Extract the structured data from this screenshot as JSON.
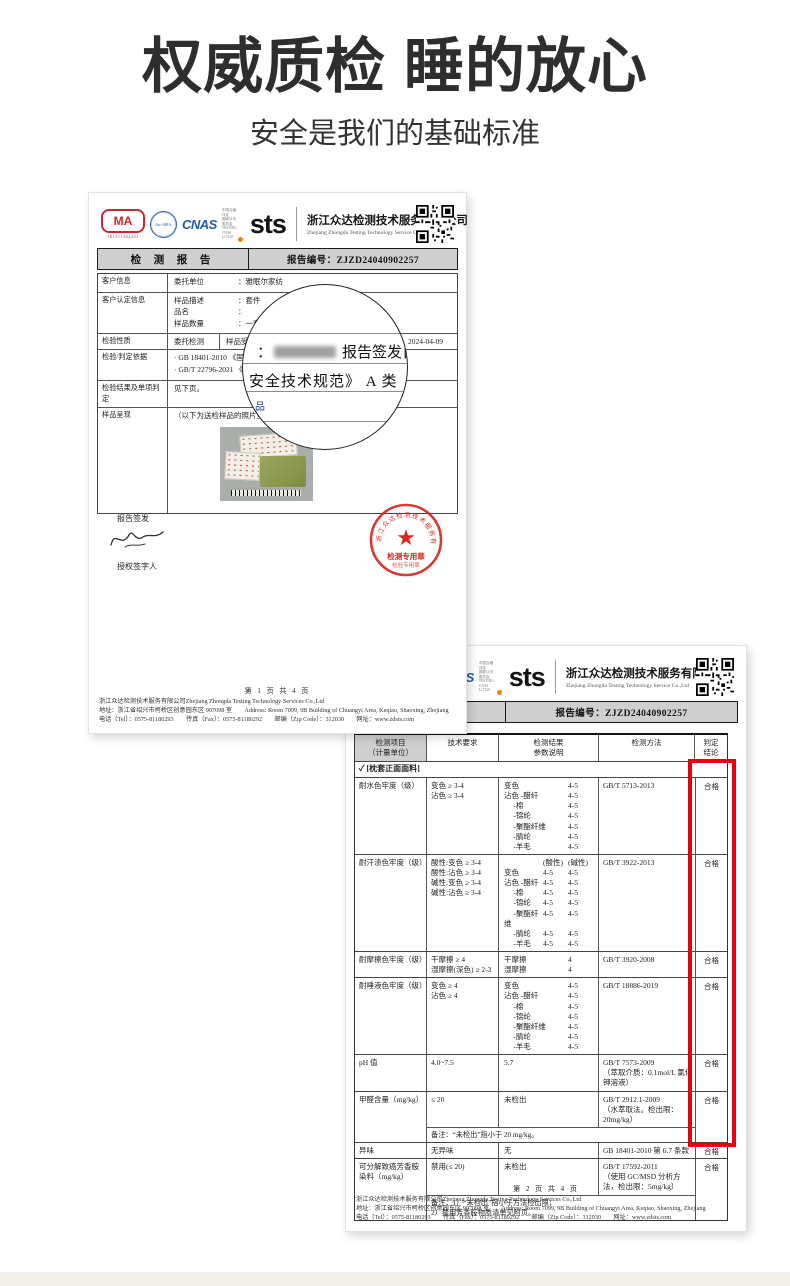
{
  "page": {
    "title": "权威质检 睡的放心",
    "subtitle": "安全是我们的基础标准"
  },
  "colors": {
    "accent_red": "#e60012",
    "stamp_red": "#d5281e",
    "logo_blue": "#1f5caa",
    "logo_orange": "#f08300",
    "bar_gray": "#cfcfcf"
  },
  "company": {
    "name_cn": "浙江众达检测技术服务有限公司",
    "name_en": "Zhejiang Zhongda Testing Technology Service Co.,Ltd",
    "logos": {
      "cma": "MA",
      "cma_number": "181511262431",
      "ilac": "ilac-MRA",
      "cnas": "CNAS",
      "cnas_side": [
        "中国合格评定",
        "国家认可",
        "委员会",
        "TESTING",
        "CNAS L17128"
      ],
      "sts": "sts",
      "qr": "qr-code-icon"
    }
  },
  "report": {
    "title_bar": "检 测 报 告",
    "report_no": "报告编号：ZJZD24040902257"
  },
  "doc1": {
    "info_rows": [
      {
        "label": "客户信息",
        "pairs": [
          [
            "委托单位",
            "：雅眠尔家纺"
          ]
        ]
      },
      {
        "label": "客户认定信息",
        "pairs": [
          [
            "样品描述",
            "：套件"
          ],
          [
            "品名",
            "："
          ],
          [
            "样品数量",
            "：一套"
          ]
        ]
      },
      {
        "label": "检验性质",
        "mid": "委托检测",
        "right_label": "样品受理日期：",
        "right_value": "2024-04-09"
      },
      {
        "label": "检验/判定依据",
        "lines": [
          "· GB 18401-2010 《国家",
          "· GB/T 22796-2021 《床"
        ]
      },
      {
        "label": "检验结果及单项判定",
        "lines": [
          "见下页。"
        ]
      },
      {
        "label": "样品呈现",
        "lines": [
          "（以下为送检样品的照片呈现）"
        ],
        "photo": true
      }
    ],
    "magnifier": {
      "line1_prefix": "：",
      "line1_suffix": "报告签发日",
      "line2": "安全技术规范》 A 类",
      "small": "品"
    },
    "sign": {
      "issue_label": "报告签发",
      "authorized_label": "授权签字人"
    },
    "stamp": {
      "ring_text": "浙江众达检测技术服务有限公司",
      "label": "检测专用章",
      "label2": "检验专用章"
    },
    "footer_page": "第 1 页 共 4 页"
  },
  "doc2": {
    "table": {
      "headers": [
        [
          "检测项目",
          "（计量单位）"
        ],
        [
          "技术要求",
          ""
        ],
        [
          "检测结果",
          "参数说明"
        ],
        [
          "检测方法",
          ""
        ],
        [
          "判定",
          "结论"
        ]
      ],
      "section": "✓ [枕套正面面料]",
      "rows": [
        {
          "item": "耐水色牢度（级）",
          "req": [
            "变色 ≥ 3-4",
            "沾色 ≥ 3-4"
          ],
          "result": [
            [
              "变色",
              "4-5"
            ],
            [
              "沾色 -醋纤",
              "4-5"
            ],
            [
              "　 -棉",
              "4-5"
            ],
            [
              "　 -锦纶",
              "4-5"
            ],
            [
              "　 -聚酯纤维",
              "4-5"
            ],
            [
              "　 -腈纶",
              "4-5"
            ],
            [
              "　 -羊毛",
              "4-5"
            ]
          ],
          "method": [
            "GB/T 5713-2013"
          ],
          "verdict": "合格"
        },
        {
          "item": "耐汗渍色牢度（级）",
          "req": [
            "酸性:变色 ≥ 3-4",
            "酸性:沾色 ≥ 3-4",
            "碱性:变色 ≥ 3-4",
            "碱性:沾色 ≥ 3-4"
          ],
          "result": [
            [
              "",
              "(酸性)",
              "(碱性)"
            ],
            [
              "变色",
              "4-5",
              "4-5"
            ],
            [
              "沾色 -醋纤",
              "4-5",
              "4-5"
            ],
            [
              "　 -棉",
              "4-5",
              "4-5"
            ],
            [
              "　 -锦纶",
              "4-5",
              "4-5"
            ],
            [
              "　 -聚酯纤维",
              "4-5",
              "4-5"
            ],
            [
              "　 -腈纶",
              "4-5",
              "4-5"
            ],
            [
              "　 -羊毛",
              "4-5",
              "4-5"
            ]
          ],
          "method": [
            "GB/T 3922-2013"
          ],
          "verdict": "合格"
        },
        {
          "item": "耐摩擦色牢度（级）",
          "req": [
            "干摩擦 ≥ 4",
            "湿摩擦(深色) ≥ 2-3"
          ],
          "result": [
            [
              "干摩擦",
              "4"
            ],
            [
              "湿摩擦",
              "4"
            ]
          ],
          "method": [
            "GB/T 3920-2008"
          ],
          "verdict": "合格"
        },
        {
          "item": "耐唾液色牢度（级）",
          "req": [
            "变色 ≥ 4",
            "沾色 ≥ 4"
          ],
          "result": [
            [
              "变色",
              "4-5"
            ],
            [
              "沾色 -醋纤",
              "4-5"
            ],
            [
              "　 -棉",
              "4-5"
            ],
            [
              "　 -锦纶",
              "4-5"
            ],
            [
              "　 -聚酯纤维",
              "4-5"
            ],
            [
              "　 -腈纶",
              "4-5"
            ],
            [
              "　 -羊毛",
              "4-5"
            ]
          ],
          "method": [
            "GB/T 18886-2019"
          ],
          "verdict": "合格"
        },
        {
          "item": "pH 值",
          "req": [
            "4.0~7.5"
          ],
          "result": [
            [
              "5.7"
            ]
          ],
          "method": [
            "GB/T 7573-2009",
            "（萃取介质：0.1mol/L 氯化钾溶液）"
          ],
          "verdict": "合格"
        },
        {
          "item": "甲醛含量（mg/kg）",
          "req": [
            "≤ 20"
          ],
          "result": [
            [
              "未检出"
            ]
          ],
          "method": [
            "GB/T 2912.1-2009",
            "（水萃取法。检出限：20mg/kg）"
          ],
          "verdict": "合格",
          "note": [
            "备注：“未检出”指小于 20 mg/kg。"
          ]
        },
        {
          "item": "异味",
          "req": [
            "无异味"
          ],
          "result": [
            [
              "无"
            ]
          ],
          "method": [
            "GB 18401-2010 第 6.7 条款"
          ],
          "verdict": "合格"
        },
        {
          "item": "可分解致癌芳香胺染料（mg/kg）",
          "req": [
            "禁用(≤ 20)"
          ],
          "result": [
            [
              "未检出"
            ]
          ],
          "method": [
            "GB/T 17592-2011",
            "（使用 GC/MSD 分析方法，检出限：5mg/kg）"
          ],
          "verdict": "合格",
          "note": [
            "备注：1）“未检出”指小于方法检出限；",
            "2）禁用芳香胺物质清单见附页。"
          ]
        }
      ]
    },
    "footer_page": "第 2 页 共 4 页"
  },
  "footer_lines": [
    "浙江众达检测技术服务有限公司Zhejiang Zhongda Testing Technology Services Co.,Ltd",
    "地址：浙江省绍兴市柯桥区创意园东区 907098 室　　Address: Room 7099, 9B Building of Chuangyi Area, Keqiao, Shaoxing, Zhejiang",
    "电话（Tel）：0575-81180293　　传真（Fax）：0575-81180292　　邮编（Zip Code）：312030　　网址：www.zdsts.com"
  ]
}
